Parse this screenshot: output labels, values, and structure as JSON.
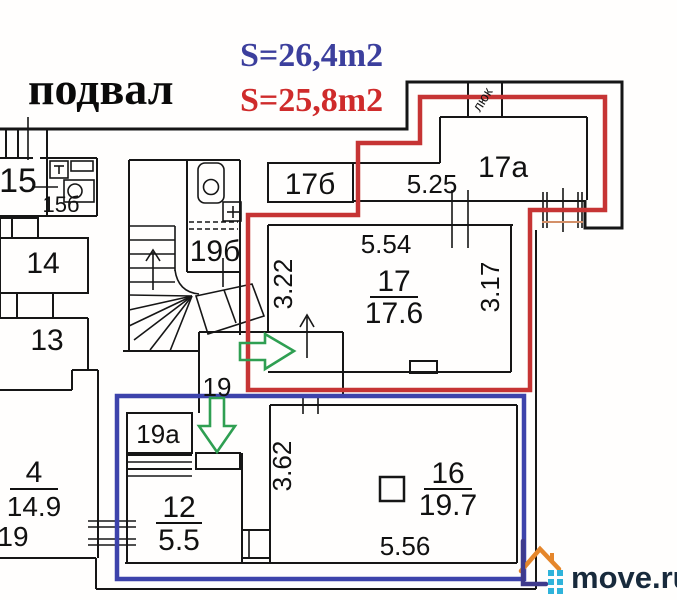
{
  "title": "подвал",
  "areas": {
    "blue_label": "S=26,4m2",
    "red_label": "S=25,8m2"
  },
  "colors": {
    "blue_text": "#3c3f9d",
    "red_text": "#cf2b2b",
    "outline_red": "#c63434",
    "outline_blue": "#3d43ab",
    "arrow_green": "#2f9f52",
    "walls": "#161616",
    "scan_tan": "#d49068",
    "logo_orange": "#e5862b",
    "logo_indigo": "#3e3a8c",
    "logo_teal": "#2fb3da",
    "logo_navy": "#182a3c"
  },
  "rooms": {
    "r15": {
      "number": "15"
    },
    "r15b": {
      "number": "15б"
    },
    "r14": {
      "number": "14"
    },
    "r13": {
      "number": "13"
    },
    "r4": {
      "number": "4",
      "area": "14.9"
    },
    "r19b": {
      "number": "19б"
    },
    "r17b": {
      "number": "17б"
    },
    "r17a": {
      "number": "17а"
    },
    "r17": {
      "number": "17",
      "area": "17.6"
    },
    "r19corridor": {
      "number": "19"
    },
    "r19left": {
      "number": "19"
    },
    "r19a": {
      "number": "19а"
    },
    "r12": {
      "number": "12",
      "area": "5.5"
    },
    "r16": {
      "number": "16",
      "area": "19.7"
    }
  },
  "dimensions": {
    "d525": "5.25",
    "d554": "5.54",
    "d322": "3.22",
    "d317": "3.17",
    "d362": "3.62",
    "d556": "5.56"
  },
  "labels": {
    "hatch": "люк"
  },
  "watermark": {
    "text": "move.ru"
  }
}
